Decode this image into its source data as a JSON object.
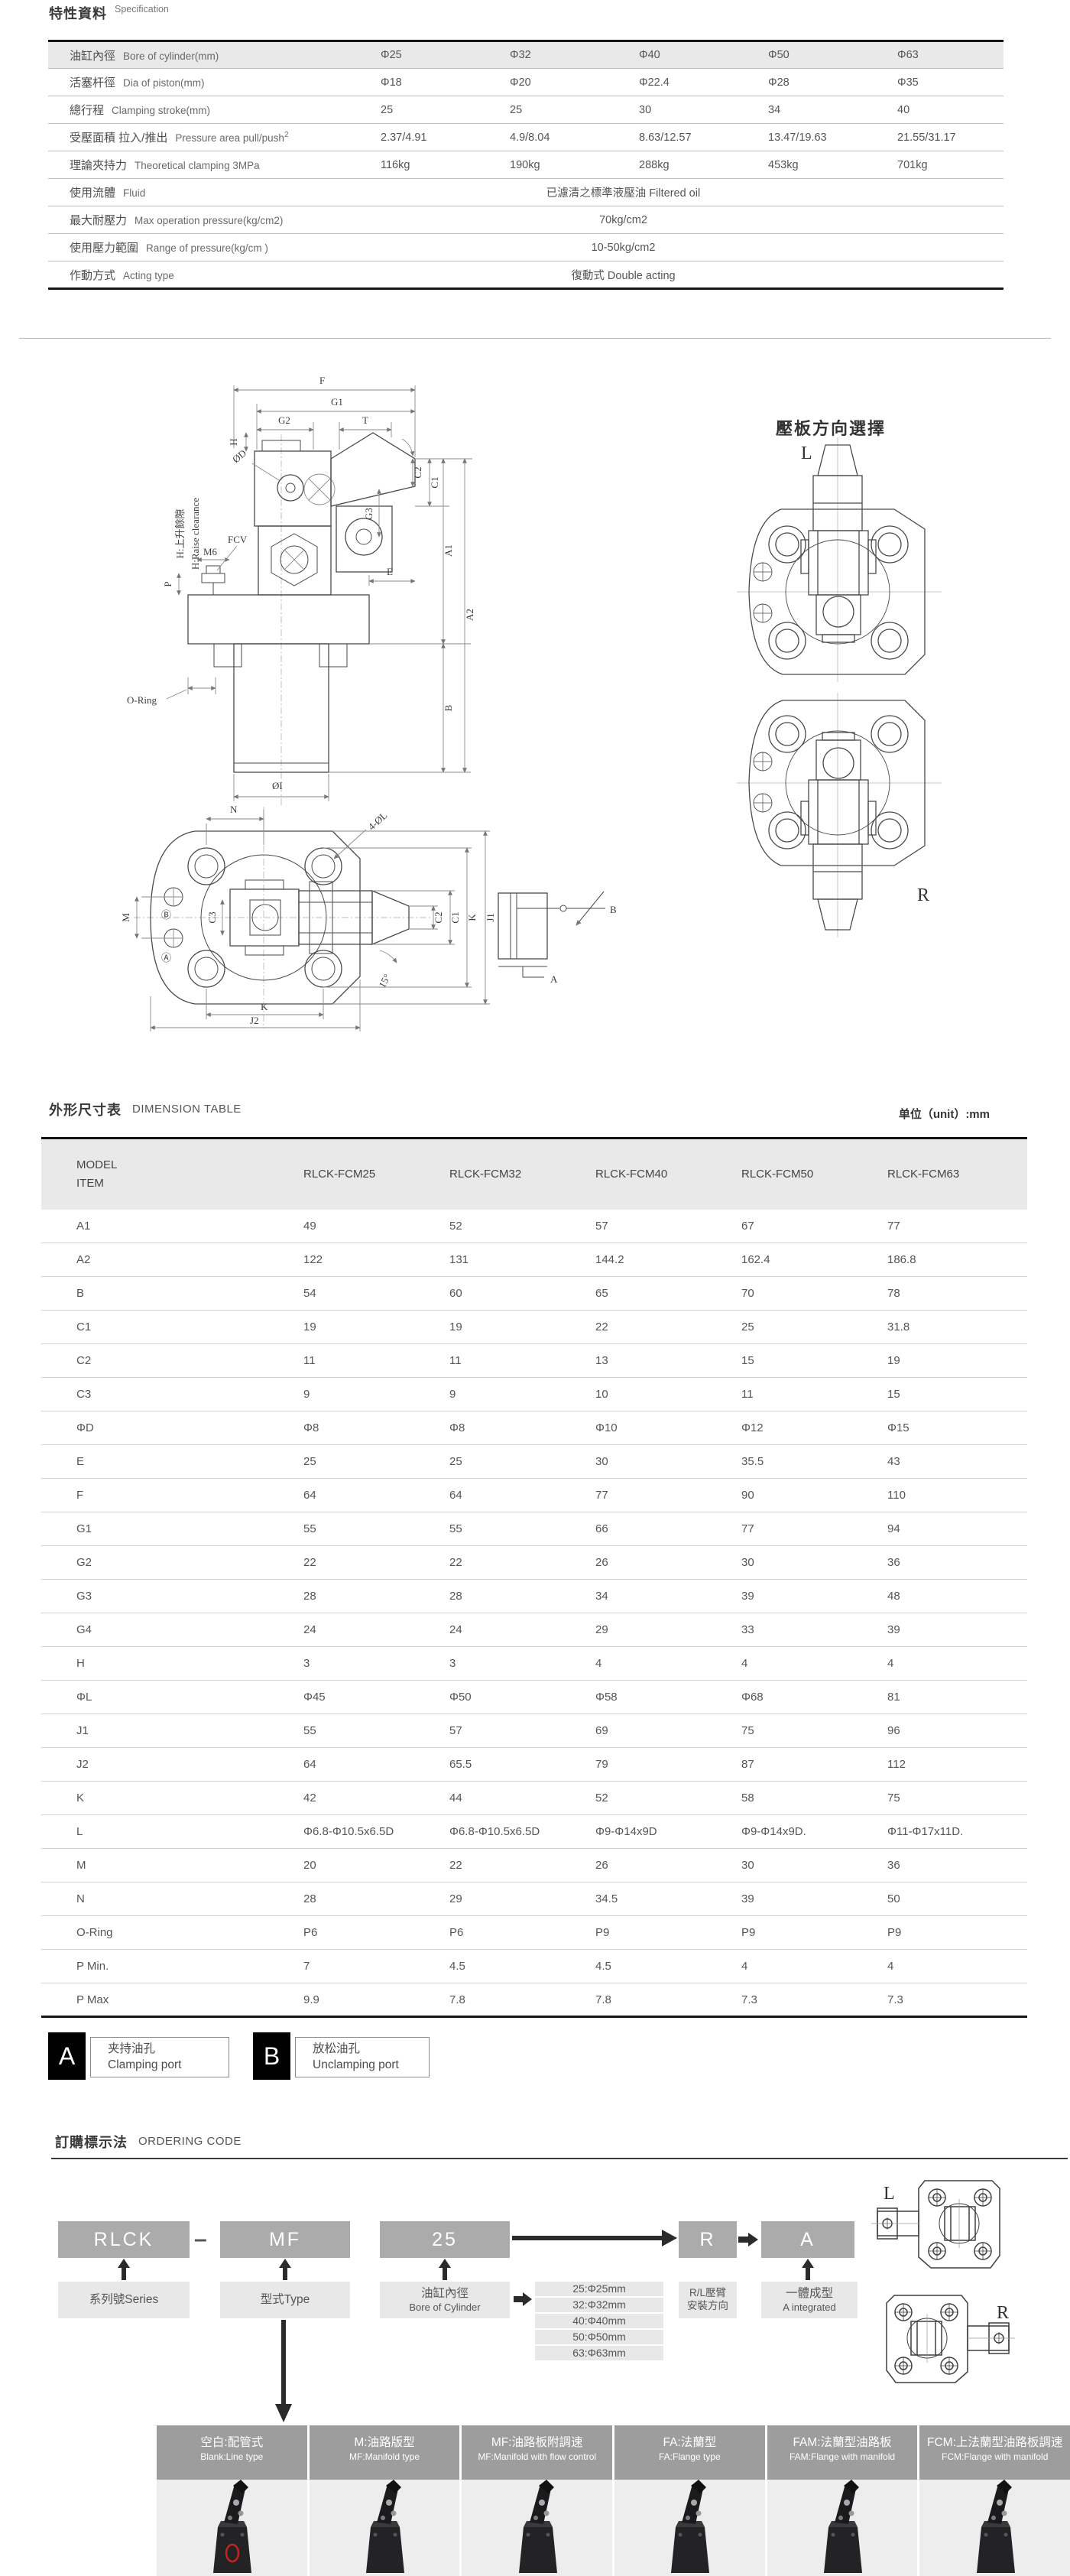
{
  "spec": {
    "title_zh": "特性資料",
    "title_en": "Specification",
    "rows": [
      {
        "zh": "油缸內徑",
        "en": "Bore of cylinder(mm)",
        "shaded": true,
        "values": [
          "Φ25",
          "Φ32",
          "Φ40",
          "Φ50",
          "Φ63"
        ]
      },
      {
        "zh": "活塞杆徑",
        "en": "Dia of piston(mm)",
        "values": [
          "Φ18",
          "Φ20",
          "Φ22.4",
          "Φ28",
          "Φ35"
        ]
      },
      {
        "zh": "總行程",
        "en": "Clamping stroke(mm)",
        "values": [
          "25",
          "25",
          "30",
          "34",
          "40"
        ]
      },
      {
        "zh": "受壓面積 拉入/推出",
        "en": "Pressure area pull/push",
        "sup": "2",
        "values": [
          "2.37/4.91",
          "4.9/8.04",
          "8.63/12.57",
          "13.47/19.63",
          "21.55/31.17"
        ]
      },
      {
        "zh": "理論夾持力",
        "en": "Theoretical clamping  3MPa",
        "values": [
          "116kg",
          "190kg",
          "288kg",
          "453kg",
          "701kg"
        ]
      },
      {
        "zh": "使用流體",
        "en": "Fluid",
        "span": "已濾清之標準液壓油  Filtered oil"
      },
      {
        "zh": "最大耐壓力",
        "en": "Max operation pressure(kg/cm2)",
        "span": "70kg/cm2"
      },
      {
        "zh": "使用壓力範圍",
        "en": "Range of pressure(kg/cm )",
        "span": "10-50kg/cm2"
      },
      {
        "zh": "作動方式",
        "en": "Acting type",
        "span": "復動式 Double acting"
      }
    ]
  },
  "drawing": {
    "labels": {
      "F": "F",
      "G1": "G1",
      "G2": "G2",
      "T": "T",
      "H": "H",
      "phiD": "ØD",
      "C1": "C1",
      "C2": "C2",
      "C3": "C3",
      "G3": "G3",
      "E": "E",
      "A1": "A1",
      "A2": "A2",
      "B": "B",
      "P": "P",
      "M6": "M6",
      "FCV": "FCV",
      "ORing": "O-Ring",
      "phiI": "ØI",
      "raise_zh": "H:上升餘隙",
      "raise_en": "H:Raise clearance",
      "N": "N",
      "fourPhiL": "4-ØL",
      "M": "M",
      "K": "K",
      "J1": "J1",
      "J2": "J2",
      "deg15": "15°",
      "circA": "Ⓐ",
      "circB": "Ⓑ",
      "portA": "A",
      "portB": "B"
    }
  },
  "plate_direction": {
    "title": "壓板方向選擇",
    "L": "L",
    "R": "R"
  },
  "dimension_table": {
    "title_zh": "外形尺寸表",
    "title_en": "DIMENSION TABLE",
    "unit": "单位（unit）:mm",
    "header": {
      "model": "MODEL",
      "item": "ITEM",
      "columns": [
        "RLCK-FCM25",
        "RLCK-FCM32",
        "RLCK-FCM40",
        "RLCK-FCM50",
        "RLCK-FCM63"
      ]
    },
    "rows": [
      {
        "item": "A1",
        "values": [
          "49",
          "52",
          "57",
          "67",
          "77"
        ]
      },
      {
        "item": "A2",
        "values": [
          "122",
          "131",
          "144.2",
          "162.4",
          "186.8"
        ]
      },
      {
        "item": "B",
        "values": [
          "54",
          "60",
          "65",
          "70",
          "78"
        ]
      },
      {
        "item": "C1",
        "values": [
          "19",
          "19",
          "22",
          "25",
          "31.8"
        ]
      },
      {
        "item": "C2",
        "values": [
          "11",
          "11",
          "13",
          "15",
          "19"
        ]
      },
      {
        "item": "C3",
        "values": [
          "9",
          "9",
          "10",
          "11",
          "15"
        ]
      },
      {
        "item": "ΦD",
        "values": [
          "Φ8",
          "Φ8",
          "Φ10",
          "Φ12",
          "Φ15"
        ]
      },
      {
        "item": "E",
        "values": [
          "25",
          "25",
          "30",
          "35.5",
          "43"
        ]
      },
      {
        "item": "F",
        "values": [
          "64",
          "64",
          "77",
          "90",
          "110"
        ]
      },
      {
        "item": "G1",
        "values": [
          "55",
          "55",
          "66",
          "77",
          "94"
        ]
      },
      {
        "item": "G2",
        "values": [
          "22",
          "22",
          "26",
          "30",
          "36"
        ]
      },
      {
        "item": "G3",
        "values": [
          "28",
          "28",
          "34",
          "39",
          "48"
        ]
      },
      {
        "item": "G4",
        "values": [
          "24",
          "24",
          "29",
          "33",
          "39"
        ]
      },
      {
        "item": "H",
        "values": [
          "3",
          "3",
          "4",
          "4",
          "4"
        ]
      },
      {
        "item": "ΦL",
        "values": [
          "Φ45",
          "Φ50",
          "Φ58",
          "Φ68",
          "81"
        ]
      },
      {
        "item": "J1",
        "values": [
          "55",
          "57",
          "69",
          "75",
          "96"
        ]
      },
      {
        "item": "J2",
        "values": [
          "64",
          "65.5",
          "79",
          "87",
          "112"
        ]
      },
      {
        "item": "K",
        "values": [
          "42",
          "44",
          "52",
          "58",
          "75"
        ]
      },
      {
        "item": "L",
        "values": [
          "Φ6.8-Φ10.5x6.5D",
          "Φ6.8-Φ10.5x6.5D",
          "Φ9-Φ14x9D",
          "Φ9-Φ14x9D.",
          "Φ11-Φ17x11D."
        ]
      },
      {
        "item": "M",
        "values": [
          "20",
          "22",
          "26",
          "30",
          "36"
        ]
      },
      {
        "item": "N",
        "values": [
          "28",
          "29",
          "34.5",
          "39",
          "50"
        ]
      },
      {
        "item": "O-Ring",
        "values": [
          "P6",
          "P6",
          "P9",
          "P9",
          "P9"
        ]
      },
      {
        "item": "P Min.",
        "values": [
          "7",
          "4.5",
          "4.5",
          "4",
          "4"
        ]
      },
      {
        "item": "P Max",
        "values": [
          "9.9",
          "7.8",
          "7.8",
          "7.3",
          "7.3"
        ]
      }
    ]
  },
  "ports": [
    {
      "code": "A",
      "zh": "夹持油孔",
      "en": "Clamping port"
    },
    {
      "code": "B",
      "zh": "放松油孔",
      "en": "Unclamping port"
    }
  ],
  "ordering": {
    "title_zh": "訂購標示法",
    "title_en": "ORDERING CODE",
    "dash": "–",
    "segments": [
      {
        "code": "RLCK",
        "line1": "系列號Series",
        "line2": ""
      },
      {
        "code": "MF",
        "line1": "型式Type",
        "line2": ""
      },
      {
        "code": "25",
        "line1": "油缸內徑",
        "line2": "Bore of Cylinder"
      },
      {
        "code": "R",
        "line1": "R/L壓臂",
        "line2": "安裝方向"
      },
      {
        "code": "A",
        "line1": "一體成型",
        "line2": "A integrated"
      }
    ],
    "bore_options": [
      "25:Φ25mm",
      "32:Φ32mm",
      "40:Φ40mm",
      "50:Φ50mm",
      "63:Φ63mm"
    ]
  },
  "products": [
    {
      "zh": "空白:配管式",
      "en": "Blank:Line type"
    },
    {
      "zh": "M:油路版型",
      "en": "MF:Manifold type"
    },
    {
      "zh": "MF:油路板附調速",
      "en": "MF:Manifold with flow control"
    },
    {
      "zh": "FA:法蘭型",
      "en": "FA:Flange type"
    },
    {
      "zh": "FAM:法蘭型油路板",
      "en": "FAM:Flange with manifold"
    },
    {
      "zh": "FCM:上法蘭型油路板調速",
      "en": "FCM:Flange with manifold"
    }
  ],
  "colors": {
    "table_header_bg": "#e9e9e9",
    "code_box_bg": "#ababab",
    "label_box_bg": "#e8e8e8",
    "product_header_bg": "#9d9d9d",
    "photo_bg": "#ededed",
    "port_box_bg": "#000000",
    "accent_red": "#c4241f"
  }
}
